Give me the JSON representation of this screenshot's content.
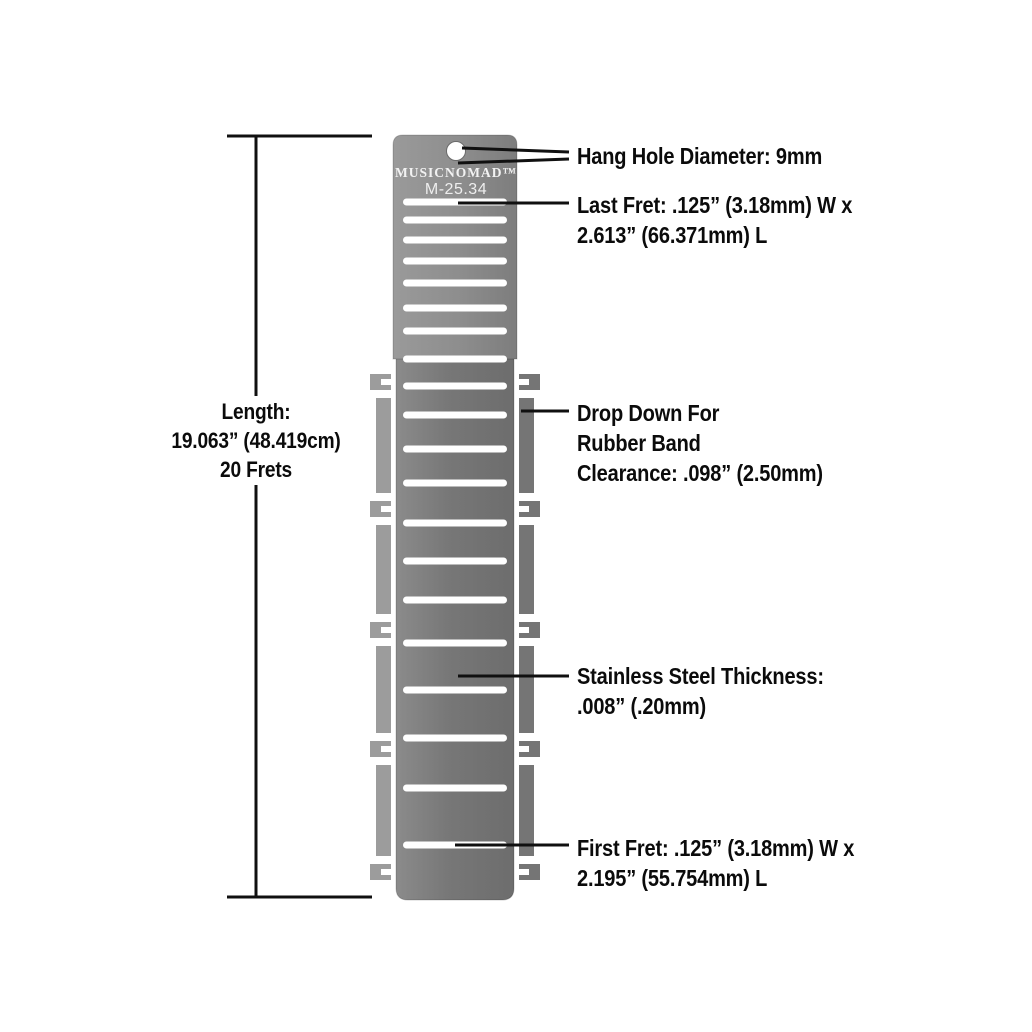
{
  "product": {
    "brand": "MUSICNOMAD™",
    "model": "M-25.34"
  },
  "dimension": {
    "lines": [
      "Length:",
      "19.063” (48.419cm)",
      "20 Frets"
    ]
  },
  "annotations": {
    "hang_hole": {
      "lines": [
        "Hang Hole Diameter: 9mm"
      ]
    },
    "last_fret": {
      "lines": [
        "Last Fret: .125” (3.18mm) W x",
        "2.613” (66.371mm) L"
      ]
    },
    "drop_down": {
      "lines": [
        "Drop Down For",
        "Rubber Band",
        "Clearance: .098” (2.50mm)"
      ]
    },
    "steel_thickness": {
      "lines": [
        "Stainless Steel Thickness:",
        ".008” (.20mm)"
      ]
    },
    "first_fret": {
      "lines": [
        "First Fret: .125” (3.18mm) W x",
        "2.195” (55.754mm) L"
      ]
    }
  },
  "tool": {
    "fret_slot_count": 20,
    "fret_slot_y": [
      202,
      220,
      240,
      261,
      283,
      308,
      331,
      359,
      386,
      415,
      449,
      483,
      523,
      561,
      600,
      643,
      690,
      738,
      788,
      845
    ],
    "notch_group_y": [
      382,
      509,
      630,
      749,
      872
    ],
    "colors": {
      "plate_top_gray": "#8f8f8f",
      "plate_main_gray": "#7a7a7a",
      "wing_left_gray": "#9c9c9c",
      "wing_right_gray": "#757575",
      "slot_white": "#ffffff",
      "annotation_text": "#0b0b0b",
      "leader_line": "#101010"
    }
  }
}
